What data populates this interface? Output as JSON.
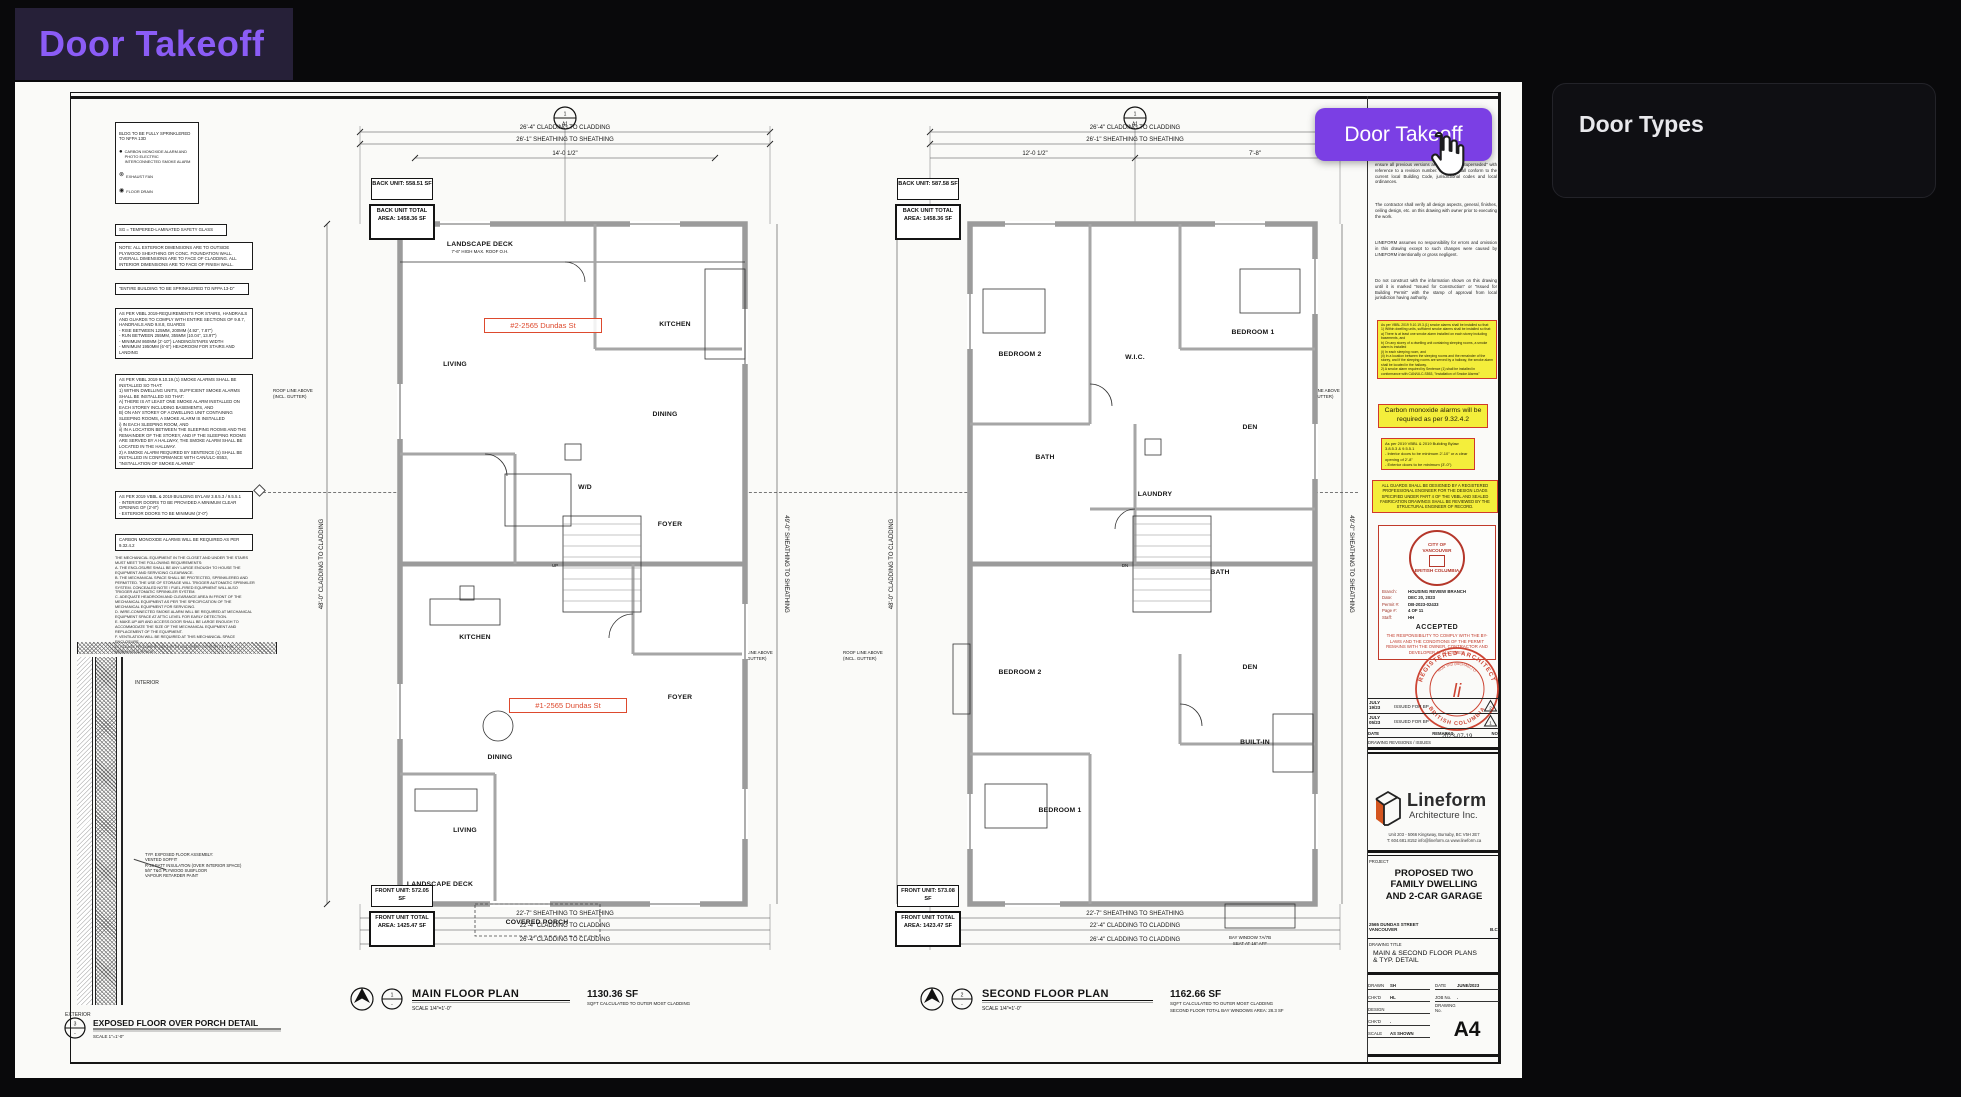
{
  "app": {
    "title": "Door Takeoff",
    "button_label": "Door Takeoff",
    "accent": "#8b5cf6",
    "button_color": "#7b3fe4"
  },
  "panel": {
    "title": "Door Types"
  },
  "legend": {
    "header": "BLDG TO BE FULLY SPRINKLERED TO NFPA 13D",
    "items": [
      {
        "icon": "co-smoke-alarm-icon",
        "label": "CARBON MONOXIDE ALARM AND PHOTO ELECTRIC INTERCONNECTED SMOKE ALARM"
      },
      {
        "icon": "exhaust-fan-icon",
        "label": "EXHAUST FAN"
      },
      {
        "icon": "floor-drain-icon",
        "label": "FLOOR DRAIN"
      }
    ]
  },
  "notes_left": [
    "SG = TEMPERED-LAMINATED SAFETY GLASS",
    "NOTE: ALL EXTERIOR DIMENSIONS ARE TO OUTSIDE PLYWOOD SHEATHING OR CONC. FOUNDATION WALL. OVERALL DIMENSIONS ARE TO FACE OF CLADDING. ALL INTERIOR DIMENSIONS ARE TO FACE OF FINISH WALL.",
    "\"ENTIRE BUILDING TO BE SPRINKLERED TO NFPA 13-D\"",
    "AS PER VBBL 2019-REQUIREMENTS FOR STAIRS, HANDRAILS AND GUARDS TO COMPLY WITH ENTIRE SECTIONS OF 9.8.7, HANDRAILS AND 9.8.8, GUARDS\n- RISE BETWEEN 125MM, 200MM (4.92\", 7.87\")\n- RUN BETWEEN 255MM, 355MM (10.04\", 13.97\")\n- MINIMUM 860MM (2'-10\") LANDING/STAIRS WIDTH\n- MINIMUM 1950MM (6'-5\") HEADROOM FOR STAIRS AND LANDING",
    "AS PER VBBL 2019 9.10.19.(1) SMOKE ALARMS SHALL BE INSTALLED SO THAT:\n1) WITHIN DWELLING UNITS, SUFFICIENT SMOKE ALARMS SHALL BE INSTALLED SO THAT:\nA) THERE IS AT LEAST ONE SMOKE ALARM INSTALLED ON EACH STOREY INCLUDING BASEMENTS, AND\nB) ON ANY STOREY OF A DWELLING UNIT CONTAINING SLEEPING ROOMS, A SMOKE ALARM IS INSTALLED\ni) IN EACH SLEEPING ROOM, AND\nii) IN A LOCATION BETWEEN THE SLEEPING ROOMS AND THE REMAINDER OF THE STOREY, AND IF THE SLEEPING ROOMS ARE SERVED BY A HALLWAY, THE SMOKE ALARM SHALL BE LOCATED IN THE HALLWAY.\n2) A SMOKE ALARM REQUIRED BY SENTENCE (1) SHALL BE INSTALLED IN CONFORMANCE WITH CAN/ULC-S553, \"INSTALLATION OF SMOKE ALARMS\"",
    "AS PER 2019 VBBL & 2019 BUILDING BYLAW 3.8.5.3 / 9.5.5.1\n- INTERIOR DOORS TO BE PROVIDED A MINIMUM CLEAR OPENING OF (2'-8\")\n- EXTERIOR DOORS TO BE MINIMUM (3'-0\")",
    "CARBON MONOXIDE ALARMS WILL BE REQUIRED AS PER 9.32.4.2",
    "THE MECHANICAL EQUIPMENT IN THE CLOSET AND UNDER THE STAIRS MUST MEET THE FOLLOWING REQUIREMENTS:\nA. THE ENCLOSURE SHALL BE ANY LARGE ENOUGH TO HOUSE THE EQUIPMENT AND SERVICING CLEARANCE.\nB. THE MECHANICAL SPACE SHALL BE PROTECTED, SPRINKLERED AND PERMITTED. THE USE OF STORAGE WILL TRIGGER AUTOMATIC SPRINKLER SYSTEM. CONCEALED NOTE / FUEL-FIRED EQUIPMENT WILL ALSO TRIGGER AUTOMATIC SPRINKLER SYSTEM.\nC. ADEQUATE HEADROOM AND CLEARANCE AREA IN FRONT OF THE MECHANICAL EQUIPMENT AS PER THE SPECIFICATION OF THE MECHANICAL EQUIPMENT FOR SERVICING.\nD. WIRE-CONNECTED SMOKE ALARM WILL BE REQUIRED AT MECHANICAL EQUIPMENT SPACE AT ATTIC LEVEL FOR EARLY DETECTION.\nE. MAKE-UP AIR AND ACCESS DOOR SHALL BE LARGE ENOUGH TO ACCOMMODATE THE SIZE OF THE MECHANICAL EQUIPMENT AND REPLACEMENT OF THE EQUIPMENT.\nF. VENTILATION WILL BE REQUIRED AT THIS MECHANICAL SPACE ENCLOSURE.\nG. PLEASE PROVIDE A LIGHT WITH OCCUPANT SENSOR AT THIS MECHANICAL SPACE."
  ],
  "notes_right": [
    "ensure all previous versions are marked as \"Superseded\" with reference to a revision number. All work shall conform to the current local Building Code, jurisdictional codes and local ordinances.",
    "The contractor shall verify all design aspects, general, finishes, ceiling design, etc. on this drawing with owner prior to executing the work.",
    "LINEFORM assumes no responsibility for errors and omission in this drawing except to such changes were caused by LINEFORM intentionally or gross negligent.",
    "Do not construct with the information shown on this drawing until it is marked \"Issued for Construction\" or \"Issued for Building Permit\" with the stamp of approval from local jurisdiction having authority."
  ],
  "highlights": [
    "As per VBBL 2019 9.10.19.3.(1) smoke alarms shall be installed so that:\n1) Within dwelling units, sufficient smoke alarms shall be installed so that:\na) There is at least one smoke alarm installed on each storey including basements, and\nb) On any storey of a dwelling unit containing sleeping rooms, a smoke alarm is installed\n(i) In each sleeping room, and\n(ii) In a location between the sleeping rooms and the remainder of the storey, and if the sleeping rooms are served by a hallway, the smoke alarm shall be located in the hallway.\n2) A smoke alarm required by Sentence (1) shall be installed in conformance with CAN/ULC-S553, \"Installation of Smoke Alarms\"",
    "Carbon monoxide alarms will be required as per 9.32.4.2",
    "As per 2019 VBBL & 2019 Building Bylaw 3.8.5.3 & 9.5.5.1\n- Interior doors to be minimum 2'-10\" or a clear opening of 2'-8\"\n- Exterior doors to be minimum (3'-0\")",
    "ALL GUARDS SHALL BE DESIGNED BY A REGISTERED PROFESSIONAL ENGINEER FOR THE DESIGN LOADS SPECIFIED UNDER PART 4 OF THE VBBL AND SEALED FABRICATION DRAWINGS SHALL BE REVIEWED BY THE STRUCTURAL ENGINEER OF RECORD."
  ],
  "city_stamp": {
    "seal_line1": "CITY OF",
    "seal_line2": "VANCOUVER",
    "seal_line3": "BRITISH COLUMBIA",
    "rows": [
      {
        "l": "Branch:",
        "v": "HOUSING REVIEW BRANCH"
      },
      {
        "l": "Date:",
        "v": "DEC 20, 2023"
      },
      {
        "l": "Permit #:",
        "v": "DB-2023-02433"
      },
      {
        "l": "Page #:",
        "v": "4 OF 11"
      },
      {
        "l": "Staff:",
        "v": "HH"
      }
    ],
    "status": "ACCEPTED",
    "disclaimer": "THE RESPONSIBILITY TO COMPLY WITH THE BY-LAWS AND THE CONDITIONS OF THE PERMIT REMAINS WITH THE OWNER, CONTRACTOR AND DEVELOPER AT ALL TIMES."
  },
  "arch_seal": {
    "ring_top": "REGISTERED ARCHITECT",
    "ring_bottom": "BRITISH COLUMBIA",
    "name": "HUN YAD (MICHAEL) LI",
    "sig": "li",
    "date": "2023-07-19"
  },
  "revisions": {
    "caption": "DRAWING REVISIONS / ISSUES",
    "header": {
      "date": "DATE",
      "remarks": "REMARKS",
      "no": "NO."
    },
    "rows": [
      {
        "date": "JULY\n19/23",
        "remarks": "ISSUED FOR BP",
        "no": "2"
      },
      {
        "date": "JULY\n05/23",
        "remarks": "ISSUED FOR BP",
        "no": "1"
      }
    ]
  },
  "titleblock": {
    "brand": "Lineform",
    "brand_sub": "Architecture Inc.",
    "address1": "Unit 203 - 5066 Kingsway, Burnaby, BC V5H 2E7",
    "address2": "T: 604.681.8152   info@lineform.ca   www.lineform.ca",
    "project_label": "PROJECT",
    "project": [
      "PROPOSED TWO",
      "FAMILY DWELLING",
      "AND 2-CAR GARAGE"
    ],
    "site1": "2565 DUNDAS STREET",
    "site2": "VANCOUVER",
    "site2b": "B.C.",
    "dt_label": "DRAWING TITLE",
    "dt1": "MAIN & SECOND FLOOR PLANS",
    "dt2": "& TYP. DETAIL",
    "f_drawn_l": "DRAWN",
    "f_drawn_v": "SH",
    "f_date_l": "DATE",
    "f_date_v": "JUNE/2023",
    "f_chkd_l": "CHK'D",
    "f_chkd_v": "HL",
    "f_job_l": "JOB No.",
    "f_job_v": ".",
    "f_design_l": "DESIGN",
    "f_dwgno_l": "DRAWING No.",
    "f_chkd2_l": "CHK'D",
    "f_chkd2_v": ".",
    "f_scale_l": "SCALE",
    "f_scale_v": "AS SHOWN",
    "sheet_no": "A4"
  },
  "detail": {
    "no": "3",
    "no_sub": "-",
    "title": "EXPOSED FLOOR OVER PORCH DETAIL",
    "scale": "SCALE 1\"=1'-0\"",
    "interior": "INTERIOR",
    "exterior": "EXTERIOR",
    "assembly": "TYP. EXPOSED FLOOR ASSEMBLY:\nVENTED SOFFIT\nR-28 BATT INSULATION (OVER INTERIOR SPACE)\n5/8\" T&G PLYWOOD SUBFLOOR\nVAPOUR RETARDER PAINT"
  },
  "plans": {
    "main": {
      "marker_top": "1",
      "marker_bottom": "A1",
      "no": "1",
      "no_sub": "-",
      "title": "MAIN FLOOR PLAN",
      "scale": "SCALE 1/4\"=1'-0\"",
      "area": "1130.36 SF",
      "area_note": "SQFT CALCULATED TO OUTER MOST CLADDING",
      "addr_back": "#2-2565 Dundas St",
      "addr_front": "#1-2565 Dundas St",
      "bu1": "BACK UNIT:",
      "bu2": "558.51 SF",
      "bt1": "BACK UNIT",
      "bt2": "TOTAL AREA:",
      "bt3": "1458.36 SF",
      "fu1": "FRONT UNIT:",
      "fu2": "572.05 SF",
      "ft1": "FRONT UNIT",
      "ft2": "TOTAL AREA:",
      "ft3": "1425.47 SF",
      "dims_top": [
        "26'-4\" CLADDING TO CLADDING",
        "26'-1\" SHEATHING TO SHEATHING",
        "14'-0 1/2\""
      ],
      "dims_bottom": [
        "22'-7\" SHEATHING TO SHEATHING",
        "22'-4\" CLADDING TO CLADDING",
        "26'-4\" CLADDING TO CLADDING"
      ],
      "dim_left": "48'-0\" CLADDING TO CLADDING",
      "dim_right": "49'-0\" SHEATHING TO SHEATHING",
      "roof1": "ROOF LINE ABOVE",
      "roof2": "(INCL. GUTTER)",
      "stair": "UP",
      "deck_note": "7'-6\" HIGH MAX. ROOF O.H.",
      "rooms": [
        "LANDSCAPE DECK",
        "LIVING",
        "KITCHEN",
        "DINING",
        "FOYER",
        "W/D",
        "KITCHEN",
        "DINING",
        "LIVING",
        "FOYER",
        "COVERED PORCH",
        "LANDSCAPE DECK"
      ]
    },
    "second": {
      "marker_top": "1",
      "marker_bottom": "A1",
      "no": "2",
      "no_sub": "-",
      "title": "SECOND FLOOR PLAN",
      "scale": "SCALE 1/4\"=1'-0\"",
      "area": "1162.66 SF",
      "area_note1": "SQFT CALCULATED TO OUTER MOST CLADDING",
      "area_note2": "SECOND FLOOR TOTAL BAY WINDOWS AREA: 28.3 SF",
      "bu1": "BACK UNIT:",
      "bu2": "587.58 SF",
      "bt1": "BACK UNIT",
      "bt2": "TOTAL AREA:",
      "bt3": "1458.36 SF",
      "fu1": "FRONT UNIT:",
      "fu2": "573.08 SF",
      "ft1": "FRONT UNIT",
      "ft2": "TOTAL AREA:",
      "ft3": "1423.47 SF",
      "dims_top": [
        "26'-4\" CLADDING TO CLADDING",
        "26'-1\" SHEATHING TO SHEATHING",
        "12'-0 1/2\"",
        "7'-8\""
      ],
      "dims_bottom": [
        "22'-7\" SHEATHING TO SHEATHING",
        "22'-4\" CLADDING TO CLADDING",
        "26'-4\" CLADDING TO CLADDING"
      ],
      "dim_left": "48'-0\" CLADDING TO CLADDING",
      "dim_right": "49'-0\" SHEATHING TO SHEATHING",
      "roof1": "ROOF LINE ABOVE",
      "roof2": "(INCL. GUTTER)",
      "stair": "DN",
      "bay1": "BAY WINDOW 7A/7B",
      "bay2": "SEAT AT 16\" AFF",
      "rooms": [
        "BEDROOM 2",
        "BEDROOM 1",
        "W.I.C.",
        "DEN",
        "BATH",
        "LAUNDRY",
        "BATH",
        "BEDROOM 2",
        "DEN",
        "BUILT-IN",
        "BEDROOM 1"
      ]
    }
  }
}
